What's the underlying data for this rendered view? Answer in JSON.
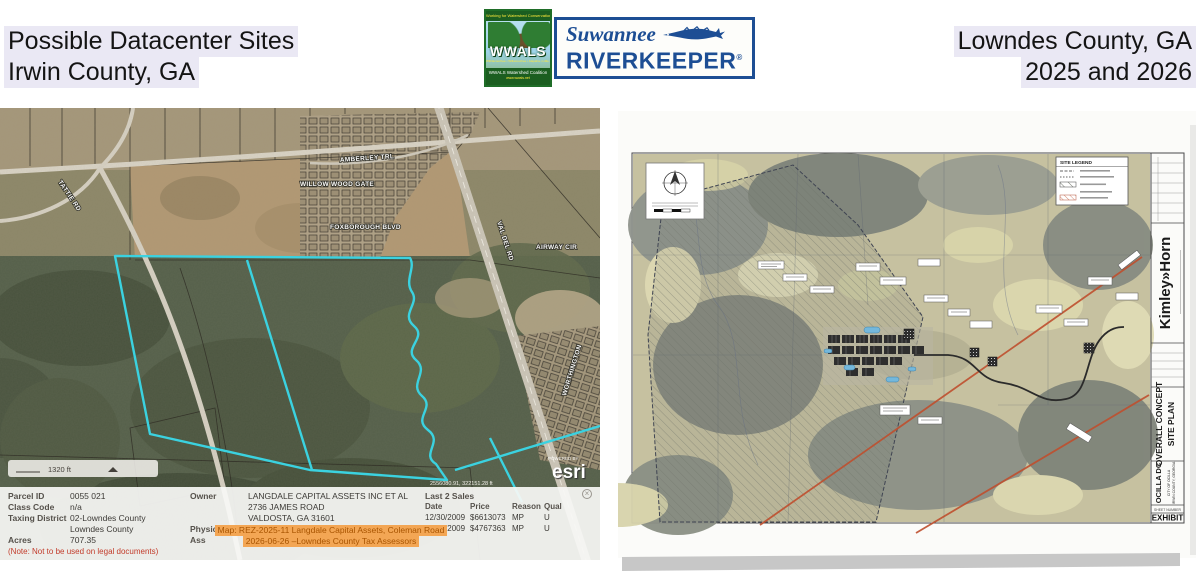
{
  "header": {
    "left_line1": "Possible Datacenter Sites",
    "left_line2": "Irwin County, GA",
    "right_line1": "Lowndes County, GA",
    "right_line2": "2025 and 2026",
    "logo": {
      "wwals_top": "Working for Watershed Conservation",
      "wwals_name": "WWALS",
      "wwals_mid": "Withlacoochee • Willacoochee • Alapaha • Little • Santa Fe • Suwannee",
      "wwals_bottom": "WWALS Watershed Coalition",
      "wwals_url": "www.wwals.net",
      "suwannee": "Suwannee",
      "riverkeeper": "RIVERKEEPER",
      "registered": "®"
    }
  },
  "map": {
    "road_labels": [
      {
        "text": "AMBERLEY TRL"
      },
      {
        "text": "WILLOW WOOD GATE"
      },
      {
        "text": "FOXBOROUGH BLVD"
      },
      {
        "text": "AIRWAY CIR"
      },
      {
        "text": "VAL DEL RD"
      },
      {
        "text": "WORTHINGTON"
      },
      {
        "text": "TATTIE RD"
      }
    ],
    "scale_label": "1320 ft",
    "powered_by": "POWERED BY",
    "esri": "esri",
    "coordinates": "2556080.91, 322151.28 ft",
    "info": {
      "fields": [
        {
          "label": "Parcel ID",
          "value": "0055 021"
        },
        {
          "label": "Class Code",
          "value": "n/a"
        },
        {
          "label": "Taxing District",
          "value": "02-Lowndes County"
        },
        {
          "label": "",
          "value": "Lowndes County"
        },
        {
          "label": "Acres",
          "value": "707.35"
        }
      ],
      "note": "(Note: Not to be used on legal documents)",
      "owner_label": "Owner",
      "owner_line1": "LANGDALE CAPITAL ASSETS INC ET AL",
      "owner_line2": "2736 JAMES ROAD",
      "owner_line3": "VALDOSTA, GA 31601",
      "physical_address_label": "Physical Address",
      "physical_address": "COLEMAN RD N",
      "assessor_label": "Ass",
      "overlay_line1": "Map: REZ-2025-11 Langdale Capital Assets, Coleman Road",
      "overlay_line2": "2026-06-26 –Lowndes County Tax Assessors",
      "sales": {
        "title": "Last 2 Sales",
        "headers": [
          "Date",
          "Price",
          "Reason",
          "Qual"
        ],
        "rows": [
          [
            "12/30/2009",
            "$6613073",
            "MP",
            "U"
          ],
          [
            "12/30/2009",
            "$4767363",
            "MP",
            "U"
          ]
        ]
      },
      "close_glyph": "×"
    }
  },
  "site_plan": {
    "legend_title": "SITE LEGEND",
    "firm": "Kimley»Horn",
    "sheet_title_line1": "OVERALL CONCEPT",
    "sheet_title_line2": "SITE  PLAN",
    "project": "OCILLA DC",
    "project_sub1": "CITY OF OCILLA",
    "project_sub2": "IRWIN COUNTY, GEORGIA",
    "sheet_number_label": "SHEET NUMBER",
    "sheet_number": "EXHIBIT"
  },
  "colors": {
    "highlight": "#eae8f4",
    "parcel_cyan": "#35d6e6",
    "orange_bg": "#f3a654",
    "orange_text": "#a85400",
    "note_red": "#c23b2a",
    "riverkeeper_blue": "#1d4e94",
    "wwals_green": "#1b5e20",
    "transmission_red": "#bf4f2e"
  }
}
